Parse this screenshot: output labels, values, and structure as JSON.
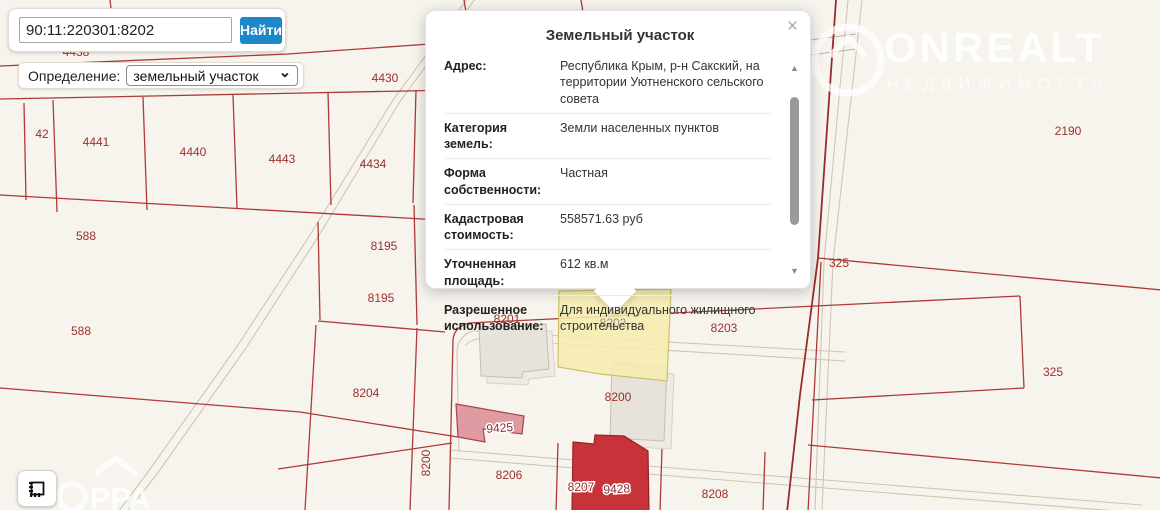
{
  "search": {
    "value": "90:11:220301:8202",
    "button_label": "Найти"
  },
  "definition": {
    "label": "Определение:",
    "selected_option": "земельный участок"
  },
  "popup": {
    "title": "Земельный участок",
    "close_label": "×",
    "rows": [
      {
        "label": "Адрес:",
        "value": "Республика Крым, р-н Сакский, на территории Уютненского сельского совета"
      },
      {
        "label": "Категория земель:",
        "value": "Земли населенных пунктов"
      },
      {
        "label": "Форма собственности:",
        "value": "Частная"
      },
      {
        "label": "Кадастровая стоимость:",
        "value": "558571.63 руб"
      },
      {
        "label": "Уточненная площадь:",
        "value": "612 кв.м"
      },
      {
        "label": "Разрешенное использование:",
        "value": "Для индивидуального жилищного строительства"
      }
    ]
  },
  "watermarks": {
    "onrealt_title": "ONREALT",
    "onrealt_subtitle": "НЕДВИЖИМОСТЬ",
    "bottom_left": "РРА"
  },
  "map": {
    "highlighted_parcel": "8202",
    "colors": {
      "background": "#f7f4ee",
      "parcel_line": "#ad3a39",
      "parcel_label": "#9c2f2e",
      "highlight_fill": "#f6edae",
      "accent_blue": "#1c87c9",
      "building_red": "#c8333a",
      "building_pink": "#df9ba1",
      "building_gray": "#e7e2da"
    },
    "labels": [
      {
        "t": "4438",
        "x": 76,
        "y": 56
      },
      {
        "t": "4430",
        "x": 385,
        "y": 82
      },
      {
        "t": "42",
        "x": 42,
        "y": 138
      },
      {
        "t": "4441",
        "x": 96,
        "y": 146
      },
      {
        "t": "4440",
        "x": 193,
        "y": 156
      },
      {
        "t": "4443",
        "x": 282,
        "y": 163
      },
      {
        "t": "4434",
        "x": 373,
        "y": 168
      },
      {
        "t": "588",
        "x": 86,
        "y": 240
      },
      {
        "t": "8195",
        "x": 384,
        "y": 250
      },
      {
        "t": "8195",
        "x": 381,
        "y": 302
      },
      {
        "t": "588",
        "x": 81,
        "y": 335
      },
      {
        "t": "8204",
        "x": 366,
        "y": 397
      },
      {
        "t": "8201",
        "x": 507,
        "y": 323
      },
      {
        "t": "8202",
        "x": 613,
        "y": 327,
        "c": "gray"
      },
      {
        "t": "8203",
        "x": 724,
        "y": 332
      },
      {
        "t": "8200",
        "x": 618,
        "y": 401
      },
      {
        "t": "8200",
        "x": 430,
        "y": 463,
        "r": -90
      },
      {
        "t": "8206",
        "x": 509,
        "y": 479
      },
      {
        "t": "8207",
        "x": 581,
        "y": 491,
        "h": 1
      },
      {
        "t": "9425",
        "x": 500,
        "y": 432,
        "h": 1,
        "b": 1,
        "r": -4
      },
      {
        "t": "9428",
        "x": 617,
        "y": 493,
        "h": 1,
        "b": 1,
        "r": -3
      },
      {
        "t": "8208",
        "x": 715,
        "y": 498
      },
      {
        "t": "2190",
        "x": 1068,
        "y": 135
      },
      {
        "t": "325",
        "x": 839,
        "y": 267
      },
      {
        "t": "325",
        "x": 1053,
        "y": 376
      }
    ]
  }
}
